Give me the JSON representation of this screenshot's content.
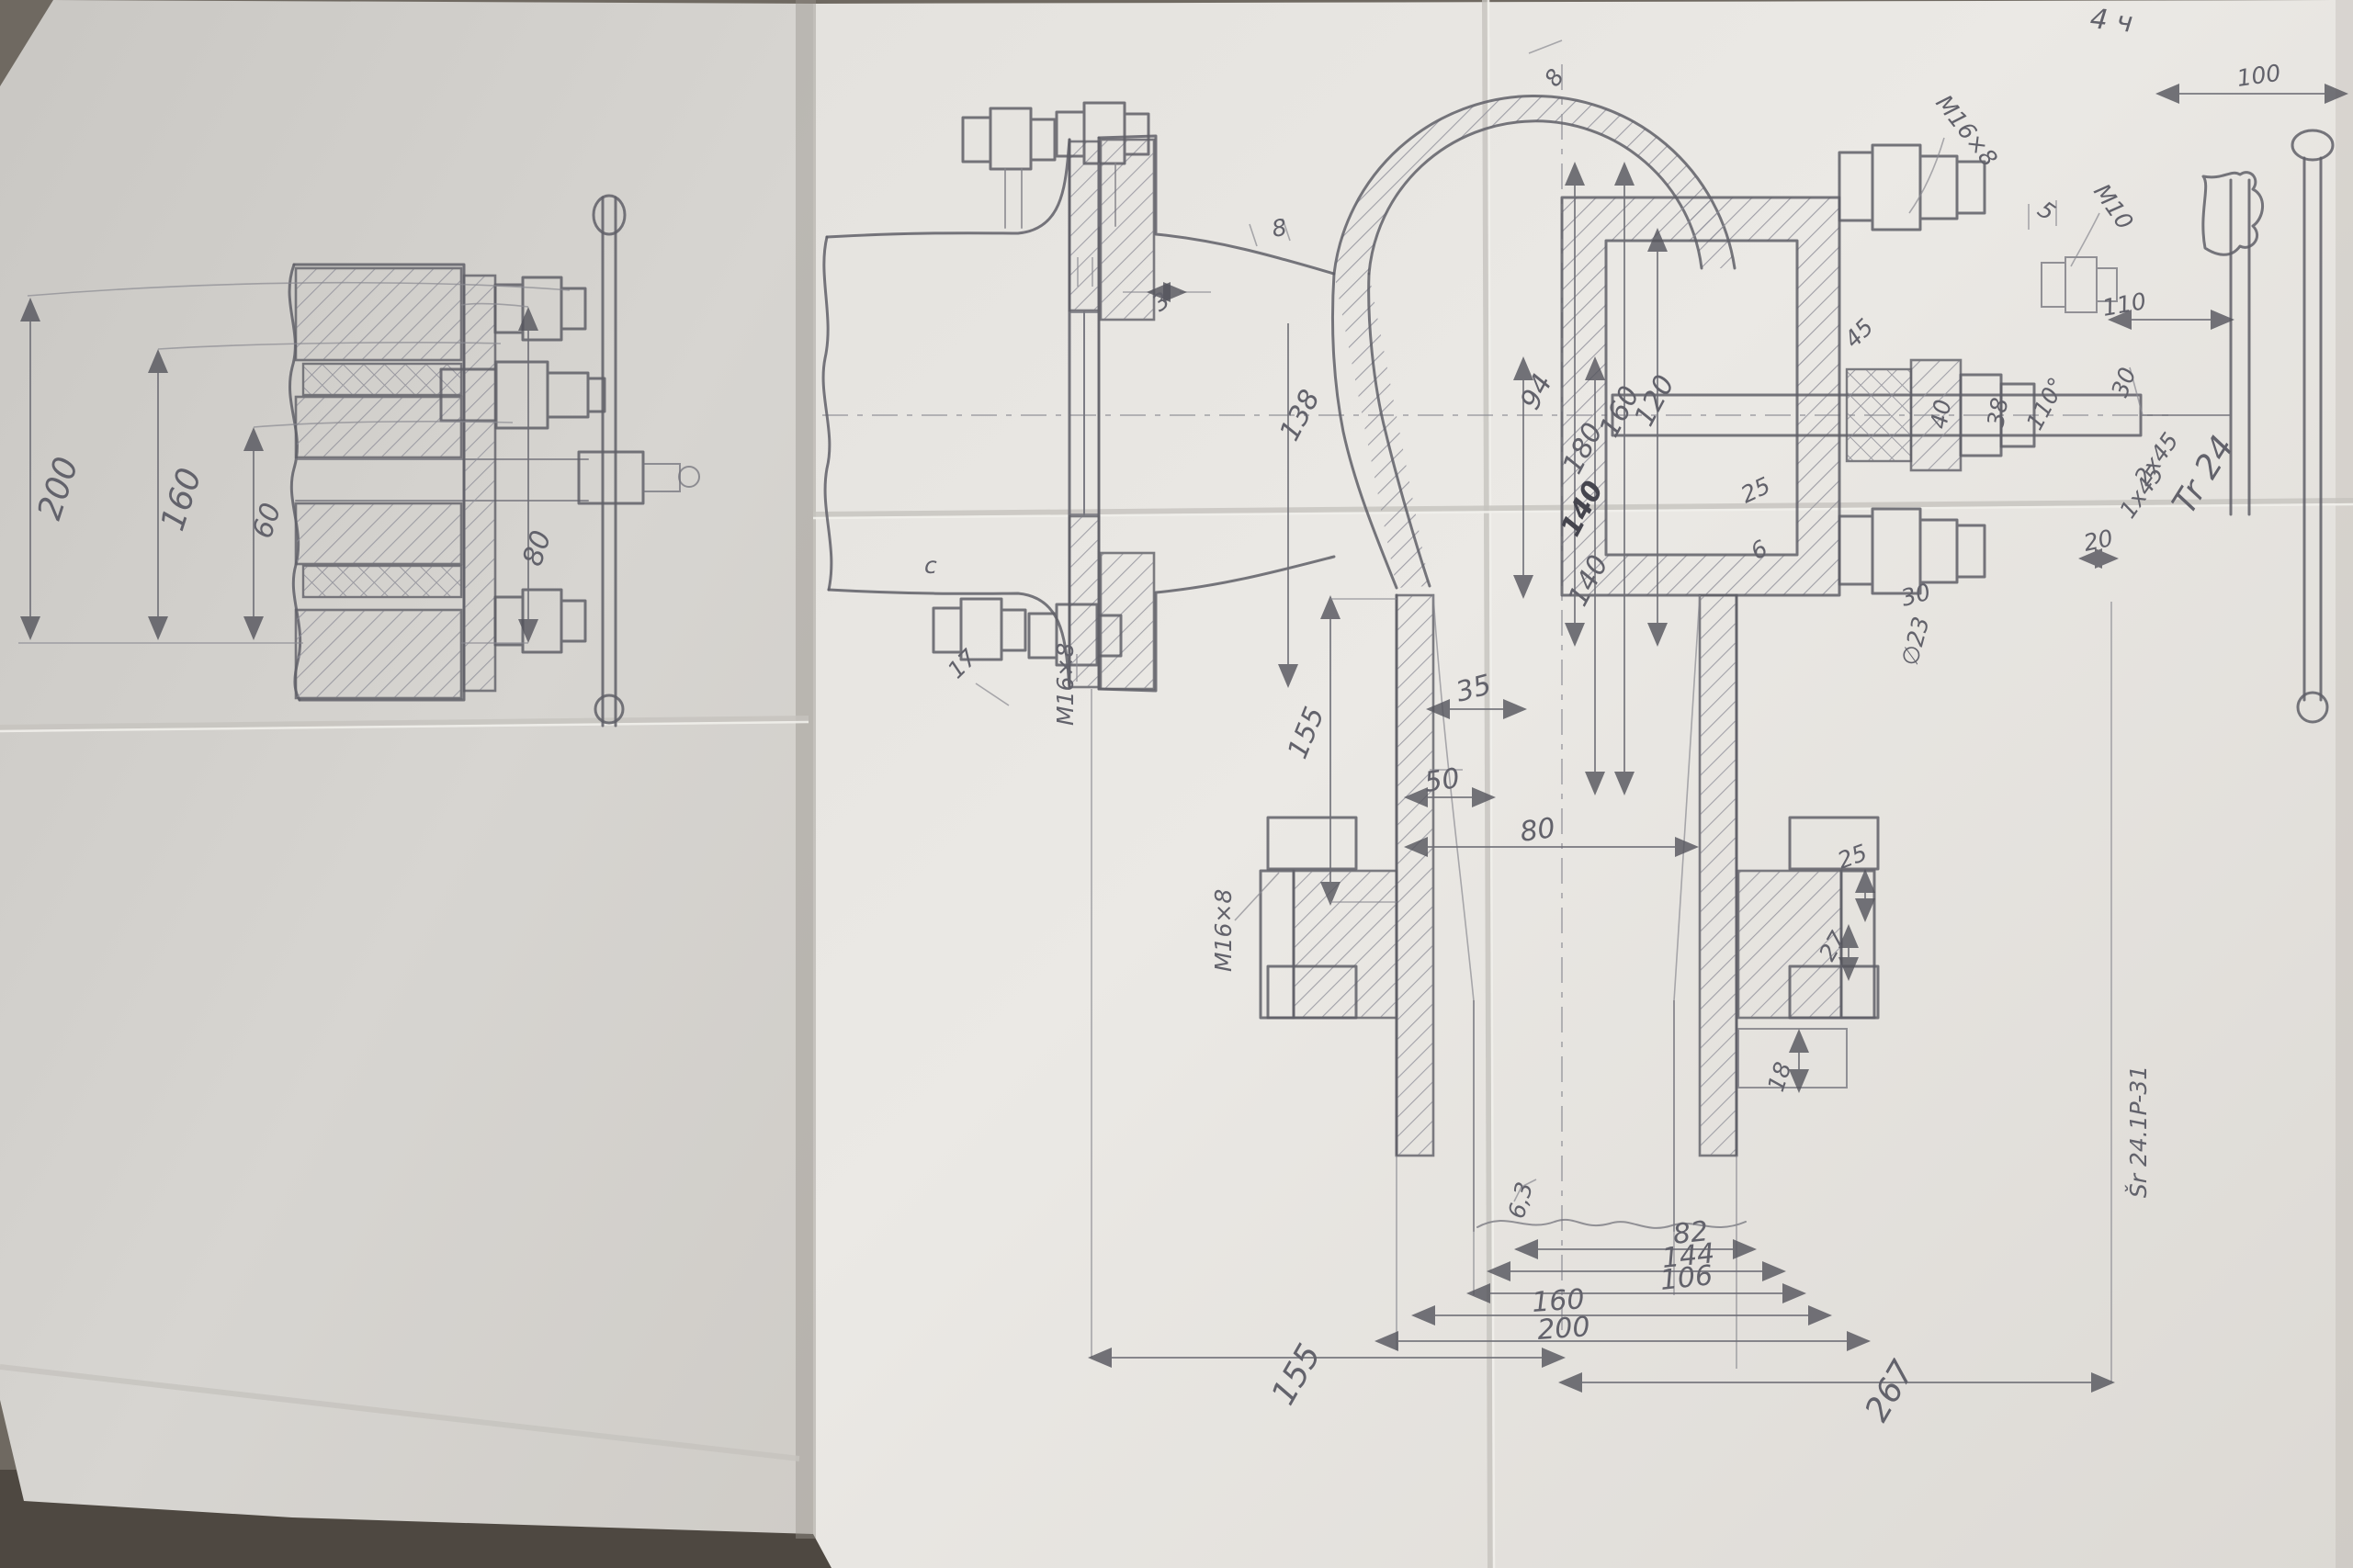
{
  "palette": {
    "background": "#6f6961",
    "background_shadow": "#4e4841",
    "left_paper": "#d6d4d0",
    "right_paper": "#e9e7e3",
    "pencil": "#5f5f67",
    "pencil_light": "#8a8a92"
  },
  "notes": {
    "corner_mark": "4 ч",
    "edge_mark": "Šr 24.1P-31"
  },
  "left_view": {
    "description": "flange assembly with handwheel, side section",
    "d200": "200",
    "d160": "160",
    "d60": "60",
    "d80": "80"
  },
  "main_view": {
    "description": "valve body cross-section with bonnet, gland, bevel gear and T-handle",
    "labels": {
      "wall8_top": "8",
      "m16_top": "M16×8",
      "d5": "5",
      "m10": "M10",
      "flange8": "8",
      "gap3": "3",
      "d138": "138",
      "d94": "94",
      "d160": "160",
      "d120": "120",
      "d180": "180",
      "d140a": "140",
      "d140b": "140",
      "d45": "45",
      "deg110": "110°",
      "d40": "40",
      "d38": "38",
      "ch2x45": "2x45",
      "ch1x45": "1x45",
      "tr24": "Tr 24",
      "d25g": "25",
      "d6": "6",
      "d30g": "30",
      "dia23": "∅23",
      "d100": "100",
      "d110": "110",
      "d30r": "30",
      "d20": "20",
      "d35": "35",
      "d50": "50",
      "d80m": "80",
      "d155m": "155",
      "d17": "17",
      "m16_mid": "M16×8",
      "cmark": "c",
      "m16_bot": "M16×8",
      "d25b": "25",
      "d27": "27",
      "d18": "18",
      "r63": "6,3",
      "d82": "82",
      "d144": "144",
      "d106": "106",
      "d160b": "160",
      "d200b": "200",
      "d155b": "155",
      "d267": "267"
    }
  }
}
